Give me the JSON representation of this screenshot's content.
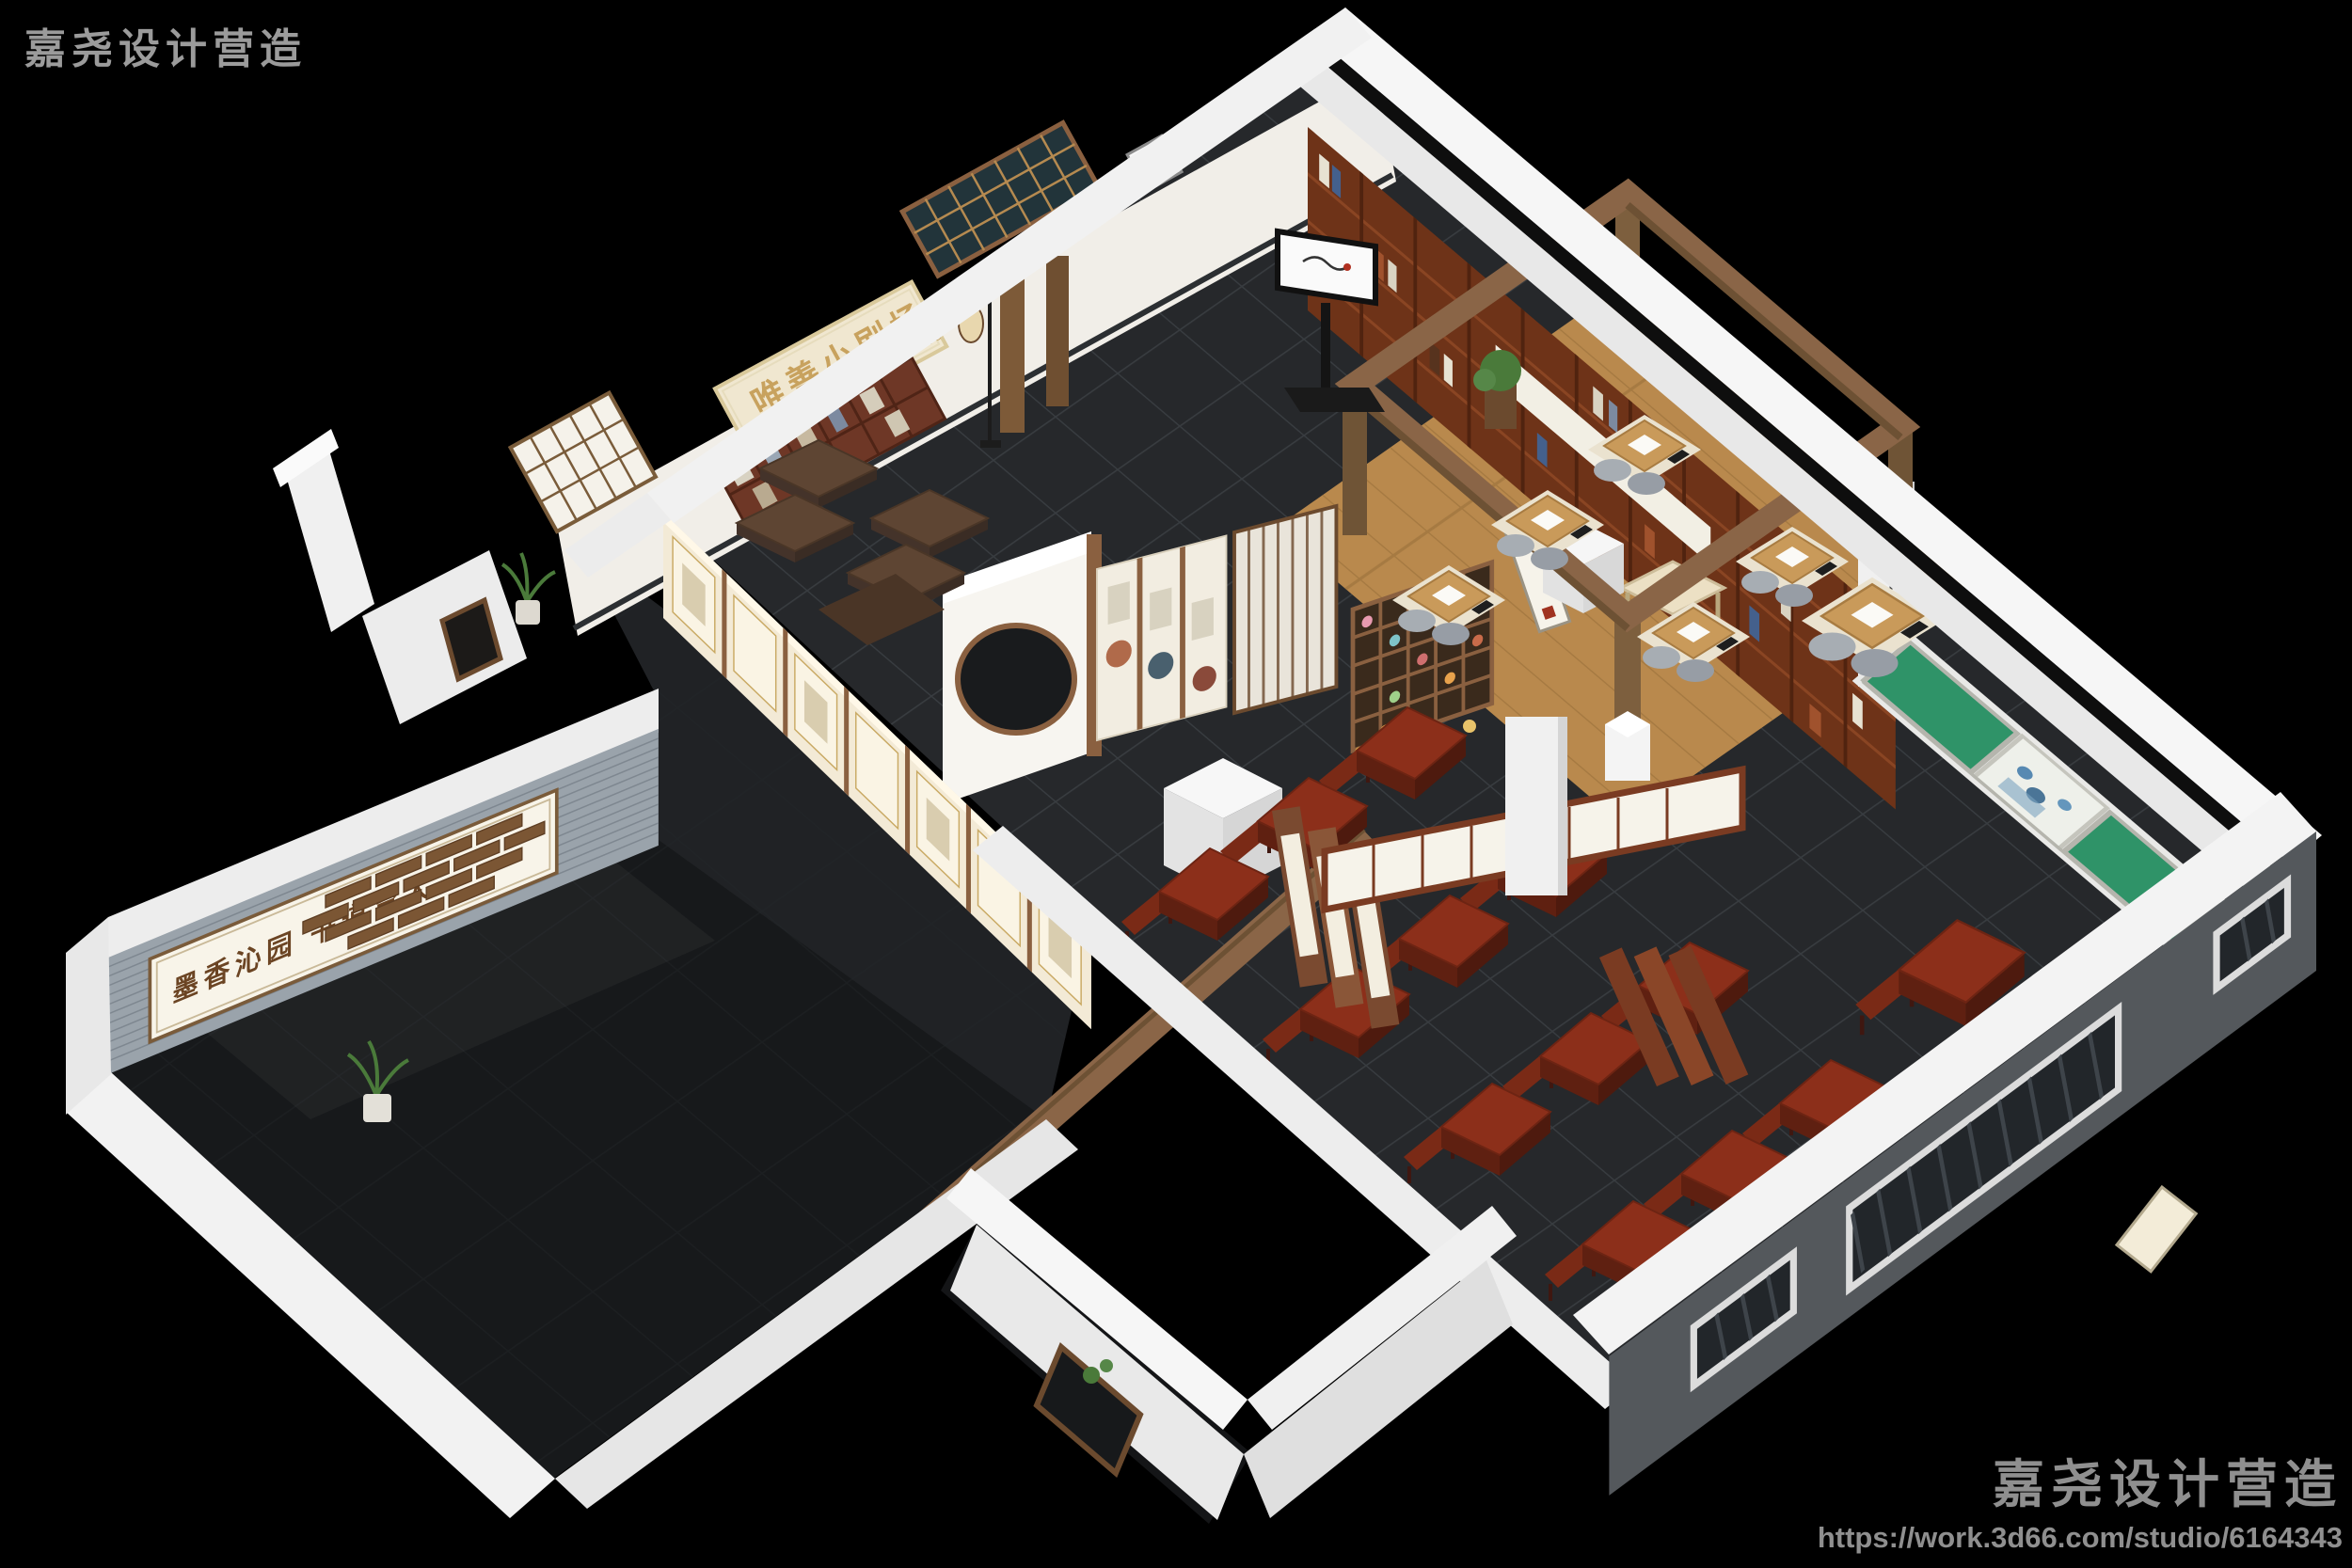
{
  "watermarks": {
    "top_left": "嘉尧设计营造",
    "bottom_right": "嘉尧设计营造",
    "studio_url": "https://work.3d66.com/studio/6164343"
  },
  "scene_text": {
    "theater_sign": "唯善小剧场",
    "theater_sign_subtitle": "WEI SHAN XIAO JU CHANG",
    "courtyard_wall_motto": "墨香沁园  书道育人",
    "exhibit_board_label": "创新"
  },
  "palette": {
    "background": "#000000",
    "wall_white": "#f2f2f2",
    "floor_tile": "#26282b",
    "courtyard_floor": "#17191b",
    "wood_floor": "#b5854a",
    "bookshelf_wood": "#6e3318",
    "desk_wood": "#8c2f1a",
    "chalkboard_green": "#2f9368",
    "brick_gray": "#9aa3ab",
    "sign_gold": "#c8a25e",
    "beam_wood": "#8a6547"
  }
}
